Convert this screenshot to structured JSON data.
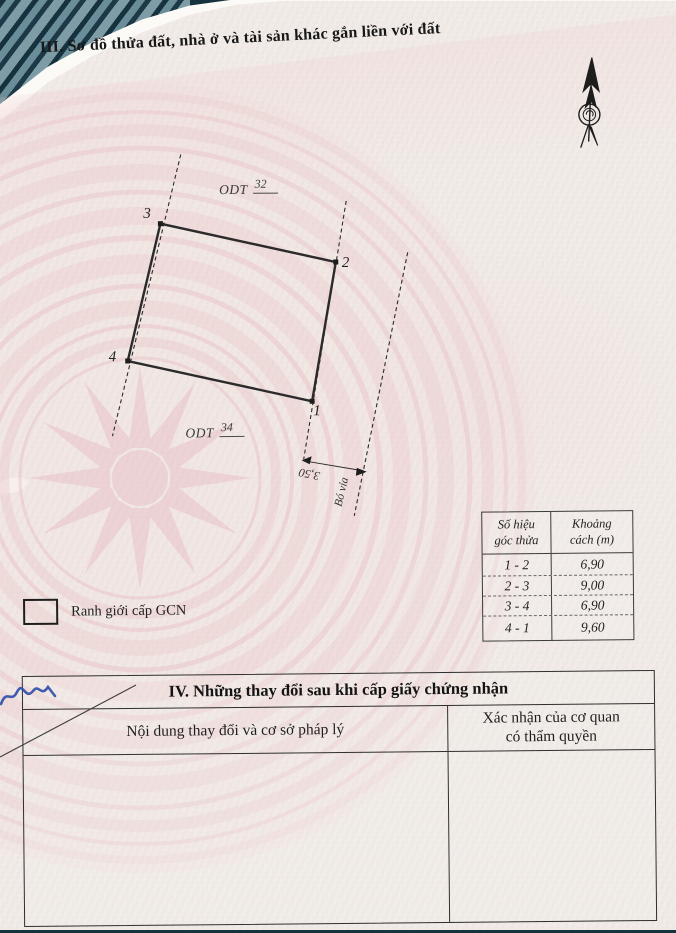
{
  "document": {
    "section3_title": "III. Sơ đồ thửa đất, nhà ở và tài sản khác gắn liền với đất",
    "section4": {
      "title": "IV. Những thay đổi sau khi cấp giấy chứng nhận",
      "col_left": "Nội dung thay đổi và cơ sở pháp lý",
      "col_right_line1": "Xác nhận của cơ quan",
      "col_right_line2": "có thẩm quyền"
    }
  },
  "diagram": {
    "north_icon": "north-arrow",
    "points": [
      {
        "label": "1"
      },
      {
        "label": "2"
      },
      {
        "label": "3"
      },
      {
        "label": "4"
      }
    ],
    "adjacent_parcels": [
      {
        "land_type": "ODT",
        "parcel_no": "32"
      },
      {
        "land_type": "ODT",
        "parcel_no": "34"
      }
    ],
    "dimension_label": "3,50",
    "curb_label": "Bó vỉa"
  },
  "legend": {
    "boundary_label": "Ranh giới cấp GCN"
  },
  "distance_table": {
    "header_col1_line1": "Số hiệu",
    "header_col1_line2": "góc thửa",
    "header_col2_line1": "Khoảng",
    "header_col2_line2": "cách (m)",
    "rows": [
      {
        "edge": "1 - 2",
        "distance": "6,90"
      },
      {
        "edge": "2 - 3",
        "distance": "9,00"
      },
      {
        "edge": "3 - 4",
        "distance": "6,90"
      },
      {
        "edge": "4 - 1",
        "distance": "9,60"
      }
    ]
  },
  "colors": {
    "paper": "#f1ece8",
    "watermark_pink": "#e9bfc5",
    "ink": "#1f1f1f",
    "pen_blue": "#2d4da8",
    "cover_teal": "#16323f"
  }
}
